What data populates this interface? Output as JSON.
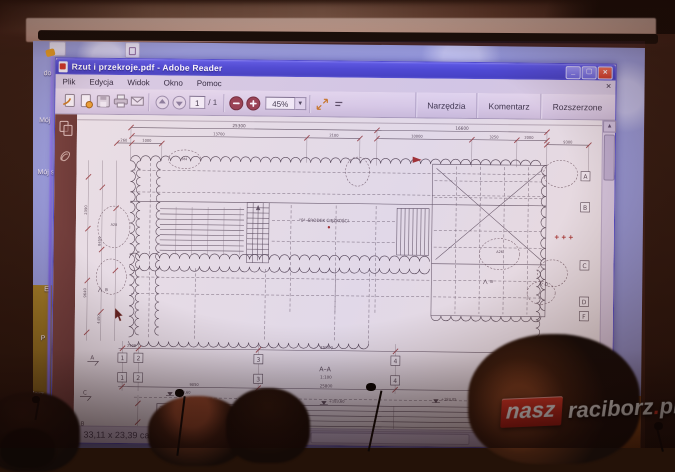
{
  "logo": {
    "nasz": "nasz",
    "raciborz": "raciborz",
    "dot": ".",
    "pl": "pl"
  },
  "desktop": {
    "icon_labels": [
      "do",
      "Mój",
      "Mój s",
      "E",
      "P",
      "Zarz"
    ]
  },
  "reader": {
    "title": "Rzut i przekroje.pdf - Adobe Reader",
    "menu": [
      "Plik",
      "Edycja",
      "Widok",
      "Okno",
      "Pomoc"
    ],
    "toolbar": {
      "page_current": "1",
      "page_sep": "/",
      "page_total": "1",
      "zoom": "45%",
      "right_buttons": [
        "Narzędzia",
        "Komentarz",
        "Rozszerzone"
      ]
    },
    "status": {
      "doc_size": "33,11 x 23,39 cale"
    }
  },
  "drawing": {
    "section_label": "A–A",
    "scale_label": "1:100",
    "detail_label": "DETAL \"a\"",
    "cog_label": "\"0\"–ŚRODEK CIĘŻKOŚCI",
    "legend": [
      "\"Y\"–M2 BALASTU",
      "\"Y\"–2 BALASTU"
    ],
    "grid_numbers": [
      "1",
      "2",
      "3",
      "4",
      "5",
      "6"
    ],
    "grid_letters": [
      "A",
      "B",
      "C",
      "D",
      "F"
    ],
    "section_marks_left": [
      "A",
      "C",
      "B"
    ],
    "section_mark_right": "A",
    "section_mark_c": "C",
    "inner_marks": [
      "B",
      "B",
      "D"
    ],
    "dims_top": [
      "260",
      "1000",
      "25300",
      "13700",
      "2100",
      "16600",
      "10000",
      "3250",
      "2000",
      "9300"
    ],
    "dims_bottom": [
      "2500",
      "25800",
      "2500",
      "9050",
      "25800",
      "550",
      "9050"
    ],
    "dims_left": [
      "2390",
      "8450",
      "9640",
      "4450"
    ],
    "levels": [
      "+183,60",
      "+183,60",
      "+183,05",
      "+187,75"
    ],
    "cloud_notes": [
      "A28",
      "M4",
      "A26"
    ]
  }
}
